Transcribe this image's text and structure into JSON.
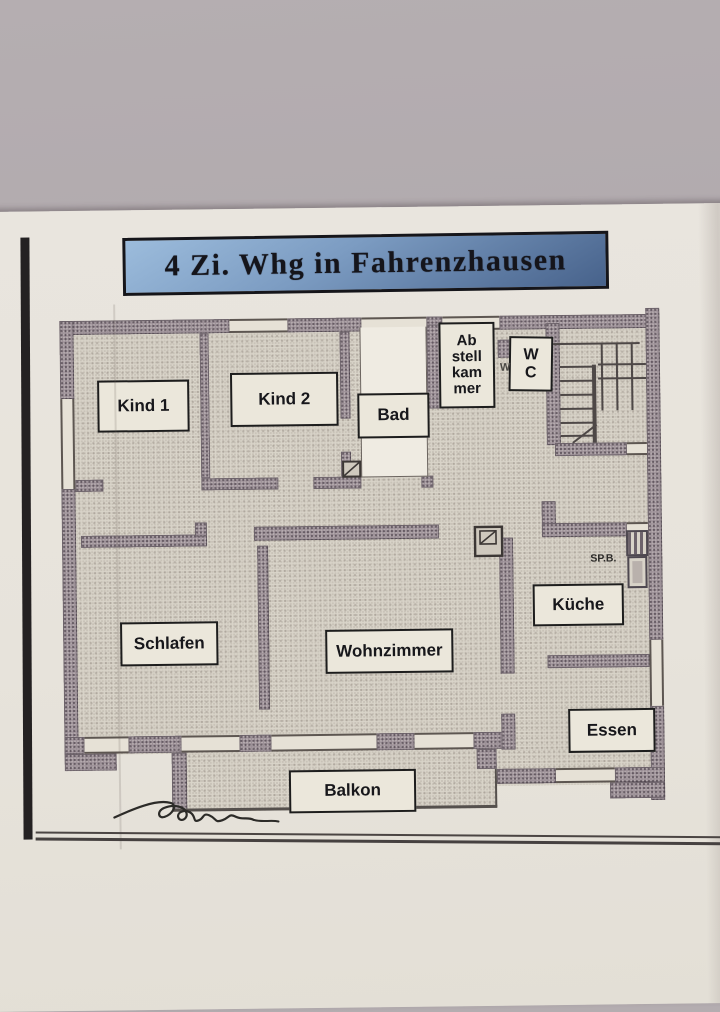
{
  "title_banner": {
    "text": "4 Zi. Whg in Fahrenzhausen"
  },
  "floorplan": {
    "rooms": {
      "kind1": {
        "label": "Kind 1"
      },
      "kind2": {
        "label": "Kind 2"
      },
      "bad": {
        "label": "Bad"
      },
      "abstellkammer": {
        "line1": "Ab",
        "line2": "stell",
        "line3": "kam",
        "line4": "mer"
      },
      "wc": {
        "line1": "W",
        "line2": "C"
      },
      "schlafen": {
        "label": "Schlafen"
      },
      "wohnzimmer": {
        "label": "Wohnzimmer"
      },
      "kueche": {
        "label": "Küche"
      },
      "essen": {
        "label": "Essen"
      },
      "balkon": {
        "label": "Balkon"
      }
    },
    "annotations": {
      "sp_b": "SP.B.",
      "w_partial": "W"
    }
  },
  "colors": {
    "backdrop": "#b5aeb1",
    "paper": "#e9e5de",
    "banner_blue_top": "#9cbcdc",
    "banner_blue_bottom": "#47628b",
    "ink": "#15151b",
    "wall": "#9c9097",
    "floor": "#d9d4c9"
  }
}
